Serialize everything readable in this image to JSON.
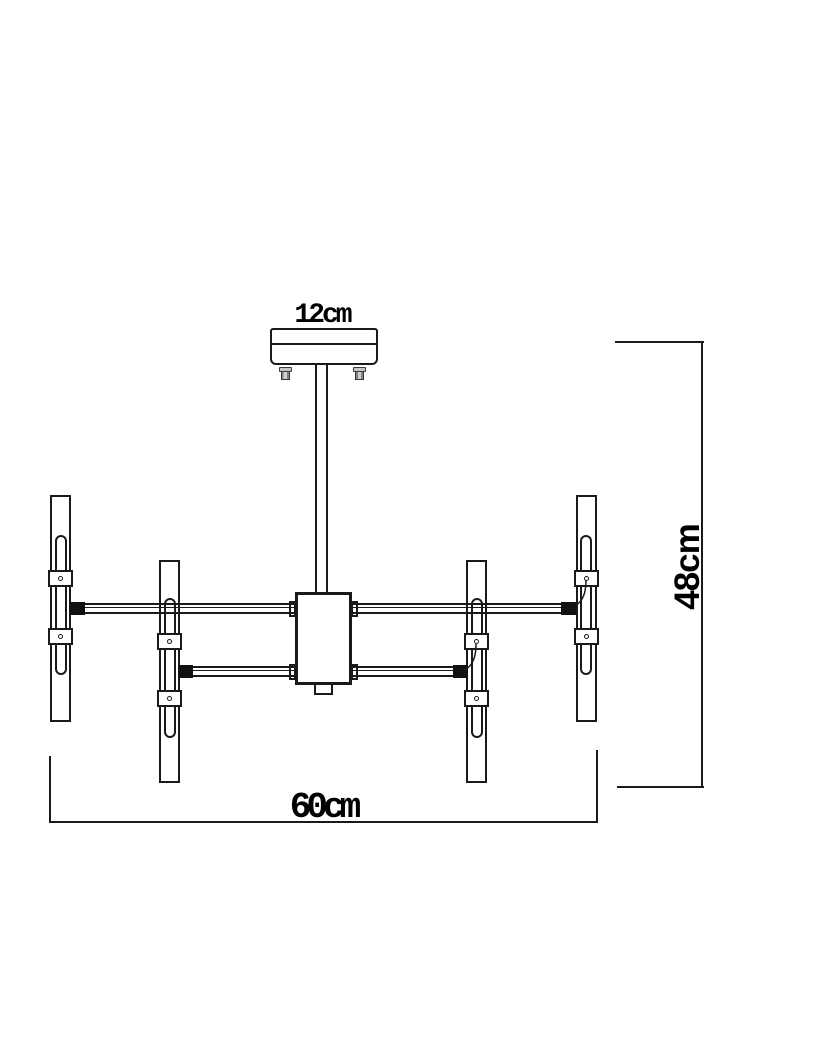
{
  "drawing": {
    "kind": "chandelier-dimension-drawing",
    "dimensions": {
      "canopy_width_label": "12cm",
      "overall_width_label": "60cm",
      "overall_height_label": "48cm"
    },
    "style": {
      "line_color": "#1a1a1a",
      "background_color": "#ffffff",
      "screw_fill": "#c4c4c4"
    }
  }
}
